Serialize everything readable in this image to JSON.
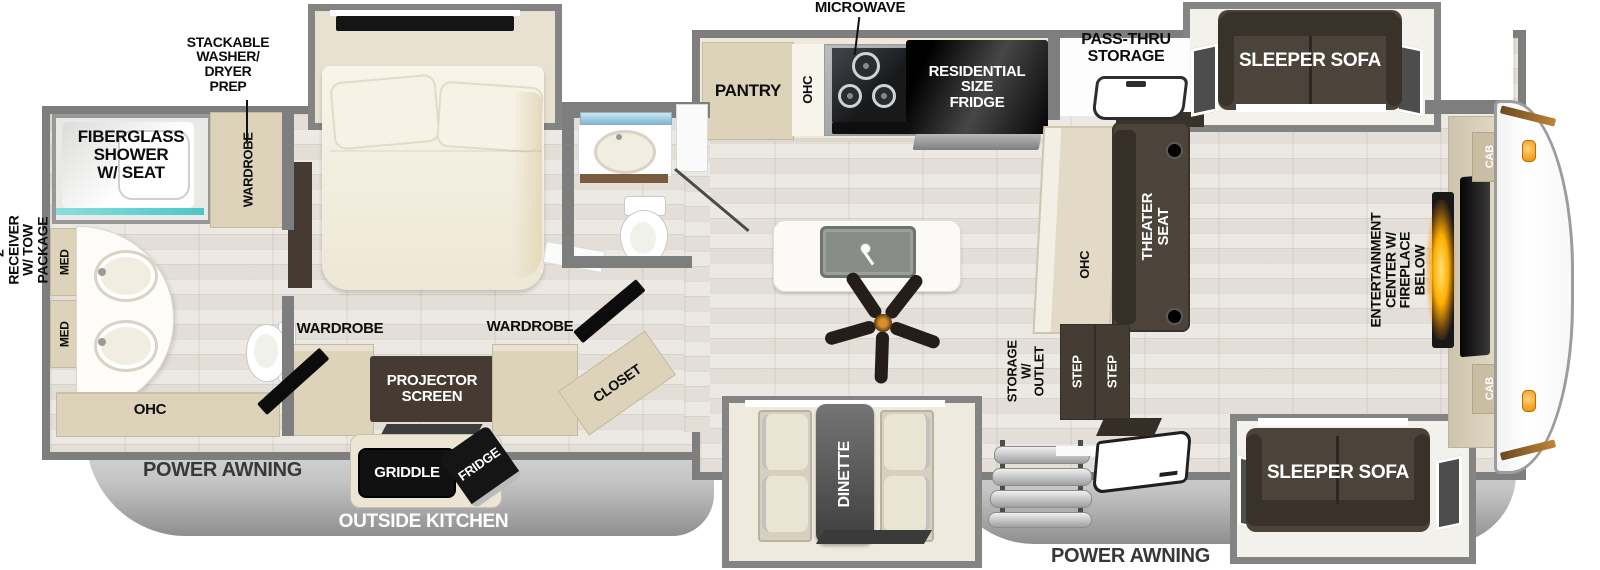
{
  "plan": {
    "exterior": {
      "receiver": "2\" RECEIVER\nW/ TOW PACKAGE",
      "power_awning_left": "POWER AWNING",
      "power_awning_right": "POWER AWNING",
      "outside_kitchen": "OUTSIDE KITCHEN",
      "griddle": "GRIDDLE",
      "outside_fridge": "FRIDGE",
      "pass_thru": "PASS-THRU\nSTORAGE"
    },
    "rear_bath": {
      "shower": "FIBERGLASS\nSHOWER\nW/ SEAT",
      "wardrobe": "WARDROBE",
      "washer_dryer": "STACKABLE\nWASHER/\nDRYER\nPREP",
      "med_upper": "MED",
      "med_lower": "MED",
      "ohc": "OHC"
    },
    "bedroom": {
      "wardrobe_left": "WARDROBE",
      "wardrobe_right": "WARDROBE",
      "projector": "PROJECTOR\nSCREEN",
      "closet": "CLOSET"
    },
    "kitchen": {
      "microwave": "MICROWAVE",
      "pantry": "PANTRY",
      "ohc": "OHC",
      "fridge": "RESIDENTIAL\nSIZE\nFRIDGE"
    },
    "living": {
      "ohc": "OHC",
      "theater_seat": "THEATER\nSEAT",
      "storage_outlet": "STORAGE\nW/ OUTLET",
      "step_left": "STEP",
      "step_right": "STEP",
      "sofa_top": "SLEEPER SOFA",
      "sofa_bottom": "SLEEPER SOFA",
      "entertainment": "ENTERTAINMENT\nCENTER W/\nFIREPLACE BELOW",
      "cab_top": "CAB",
      "cab_bottom": "CAB"
    },
    "dinette": {
      "label": "DINETTE"
    }
  }
}
